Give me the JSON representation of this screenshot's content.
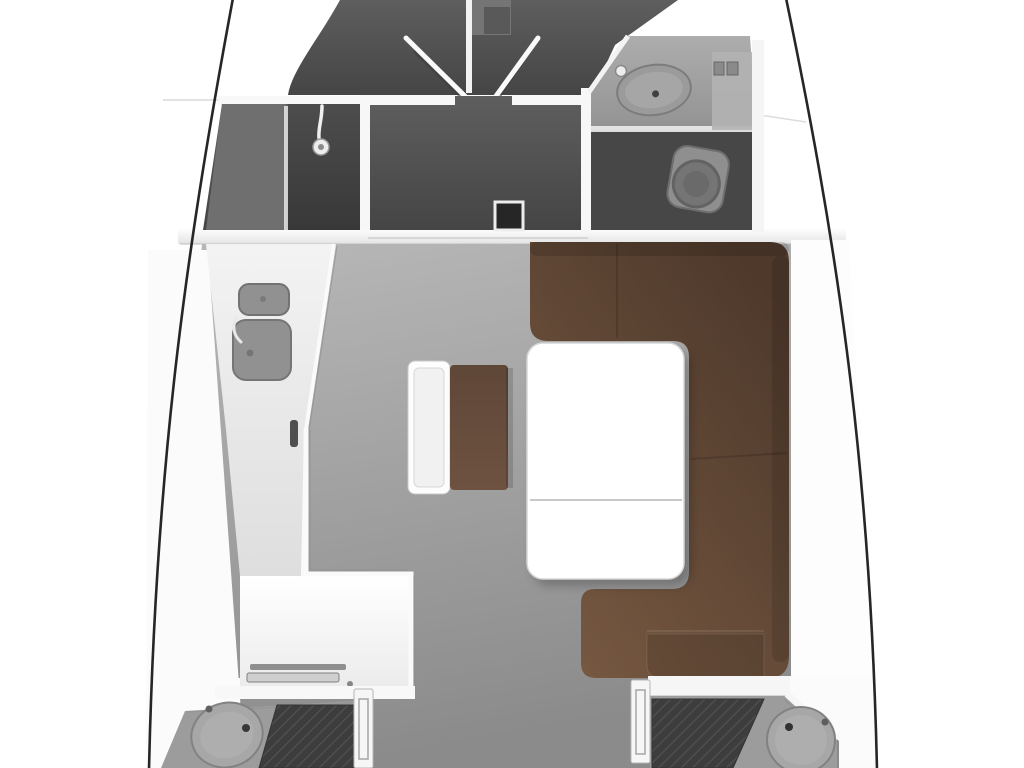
{
  "image": {
    "kind": "sailing-yacht-interior-floor-plan",
    "view": "top-down"
  },
  "colors": {
    "background": "#ffffff",
    "hull_line": "#262626",
    "wall_white": "#f7f7f7",
    "deck_white": "#fbfbfb",
    "bulkhead_top": "#ffffff",
    "bulkhead_bottom": "#e4e4e4",
    "room_top": "#5e5e5e",
    "room_bottom": "#454545",
    "bathroom_floor": "#474747",
    "shower_room_light": "#6f6f6f",
    "floor_top": "#b8b8b8",
    "floor_bottom": "#8b8b8b",
    "galley_counter_top": "#f3f3f3",
    "galley_counter_bottom": "#dedede",
    "bath_counter_top": "#adadad",
    "bath_counter_bottom": "#939393",
    "cabin_counter": "#9c9c9c",
    "galley_sink": "#919191",
    "sink_basin": "#9b9b9b",
    "aft_sink_basin": "#a7a7a7",
    "sink_rim": "#7a7a7a",
    "toilet_body": "#8f8f8f",
    "toilet_bowl": "#757575",
    "sofa_outer": "#4e392b",
    "sofa_inner": "#765841",
    "bench_seat_top": "#5f4737",
    "bench_seat_bottom": "#6e5241",
    "bed_base": "#383838",
    "bed_weave": "#4d4d4d",
    "table_fill": "#ffffff",
    "desk_fill": "#ffffff"
  },
  "rooms": [
    {
      "id": "bow-cabin",
      "label": "bow v-berth cabin"
    },
    {
      "id": "shower-room",
      "label": "shower room"
    },
    {
      "id": "forward-cabin",
      "label": "forward cabin"
    },
    {
      "id": "bathroom",
      "label": "head with sink and toilet"
    },
    {
      "id": "salon",
      "label": "main salon"
    },
    {
      "id": "galley",
      "label": "galley with double sink"
    },
    {
      "id": "nav-station",
      "label": "navigation desk"
    },
    {
      "id": "port-aft-cabin",
      "label": "port aft cabin"
    },
    {
      "id": "starboard-aft-cabin",
      "label": "starboard aft cabin"
    }
  ],
  "furniture": [
    "v-doors",
    "shower-head",
    "bathroom-sink",
    "toilet",
    "galley-sink-small",
    "galley-sink-large",
    "galley-faucet",
    "nav-instruments",
    "settee-sofa",
    "corner-cushion",
    "salon-table",
    "bench-backrest",
    "bench-seat",
    "port-berth",
    "port-sink",
    "starboard-berth",
    "starboard-sink"
  ]
}
